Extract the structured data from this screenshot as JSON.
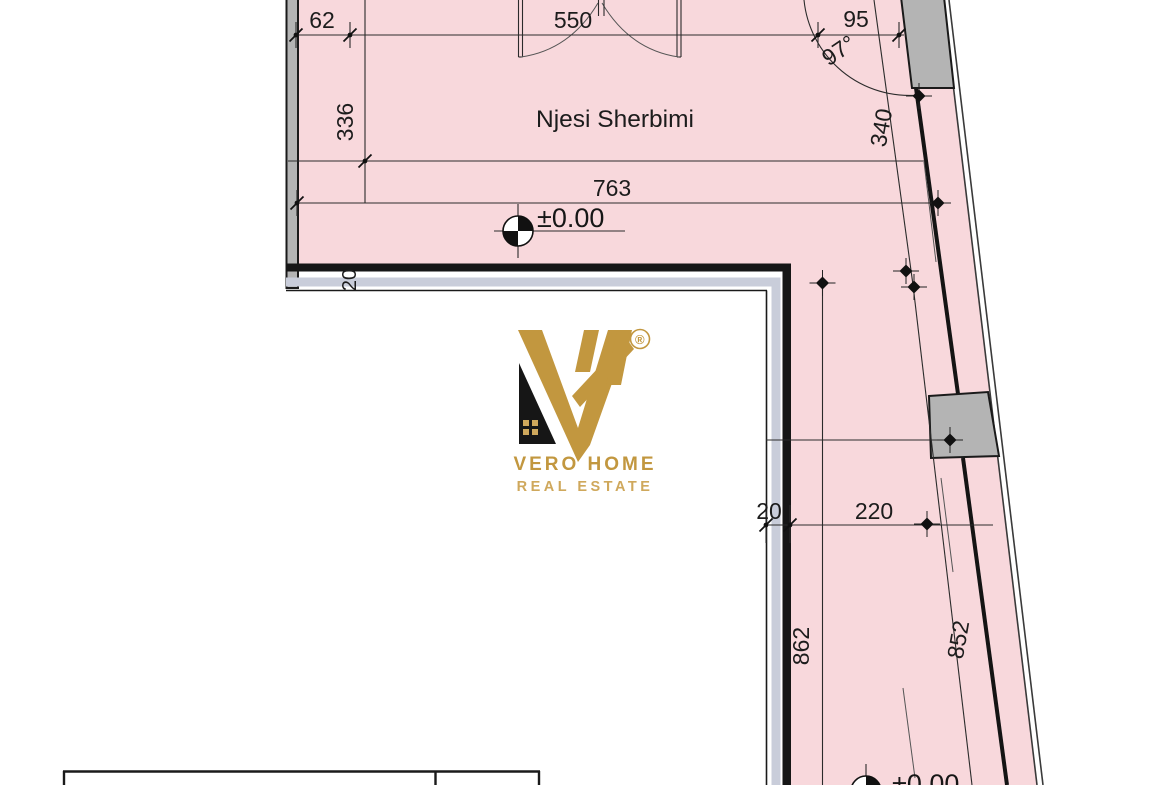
{
  "drawing": {
    "room_label": "Njesi Sherbimi",
    "level_marker": "±0.00",
    "level_marker_bottom": "±0.00",
    "angle_label": "97°",
    "dims": {
      "top_left": "62",
      "top_door": "550",
      "top_right": "95",
      "left_height": "336",
      "room_width": "763",
      "wall_upper_right": "340",
      "wall_thickness_top": "20",
      "wall_thickness_corridor": "20",
      "corridor_width": "220",
      "corridor_height_left": "862",
      "corridor_height_right": "852"
    }
  },
  "logo": {
    "registered": "®",
    "name": "VERO HOME",
    "tagline": "REAL ESTATE"
  },
  "colors": {
    "floor_pink": "#f8d8dc",
    "wall_gray": "#b4b4b4",
    "wall_band": "#c9cdda",
    "line_dark": "#1a1a1a",
    "logo_gold": "#c2973f",
    "logo_gold_light": "#cfa85c",
    "logo_black": "#161616"
  }
}
